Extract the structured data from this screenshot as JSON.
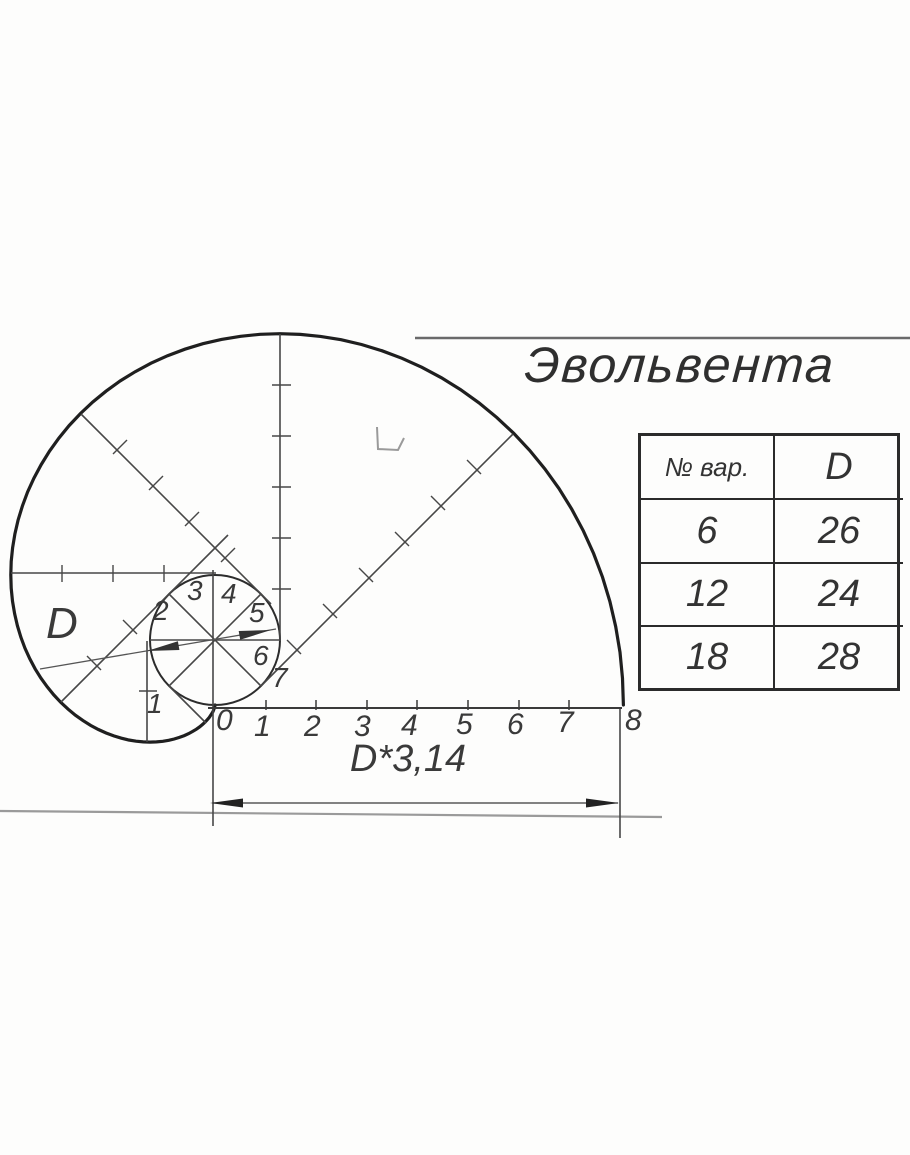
{
  "title": "Эвольвента",
  "diagram": {
    "diameter_label": "D",
    "circumference_label": "D*3,14",
    "axis_labels": [
      "0",
      "1",
      "2",
      "3",
      "4",
      "5",
      "6",
      "7",
      "8"
    ],
    "sector_labels": [
      "1",
      "2",
      "3",
      "4",
      "5",
      "6",
      "7"
    ],
    "surface_mark": "check-mark",
    "colors": {
      "ink": "#2a2a2a",
      "light_line": "#999999",
      "paper": "#fdfdfc"
    }
  },
  "table": {
    "headers": [
      "№ вар.",
      "D"
    ],
    "rows": [
      [
        "6",
        "26"
      ],
      [
        "12",
        "24"
      ],
      [
        "18",
        "28"
      ]
    ]
  }
}
